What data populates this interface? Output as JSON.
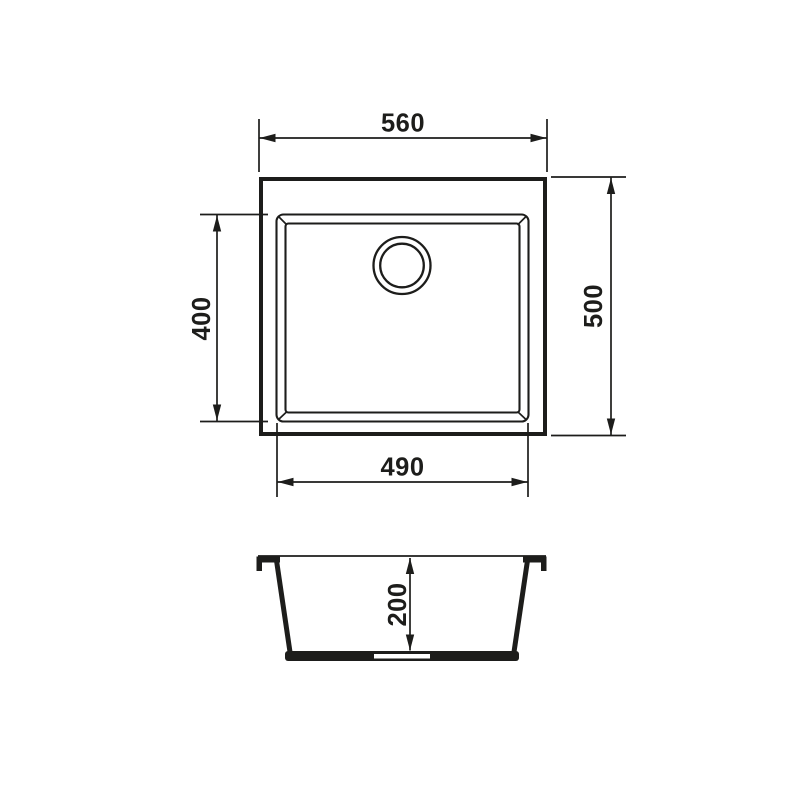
{
  "colors": {
    "line": "#1d1d1b",
    "background": "#ffffff"
  },
  "dimensions": {
    "top_width": "560",
    "right_height": "500",
    "left_height": "400",
    "bottom_width": "490",
    "section_depth": "200"
  }
}
